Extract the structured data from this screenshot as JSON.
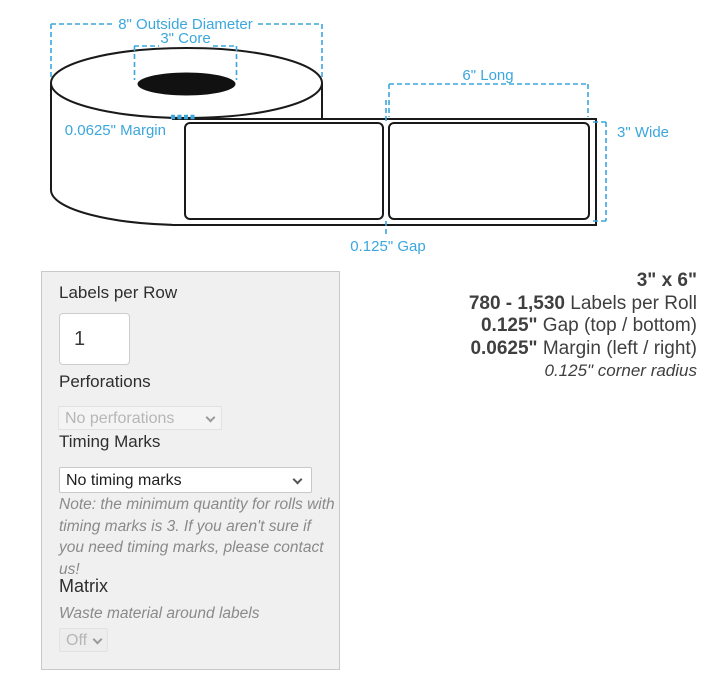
{
  "colors": {
    "annotation": "#3ba7dc",
    "panel_bg": "#f0f0f0",
    "line": "#1a1a1a"
  },
  "diagram": {
    "outside_diameter_label": "8\" Outside Diameter",
    "core_label": "3\" Core",
    "margin_label": "0.0625\" Margin",
    "long_label": "6\" Long",
    "wide_label": "3\" Wide",
    "gap_label": "0.125\" Gap"
  },
  "options_panel": {
    "labels_per_row": {
      "label": "Labels per Row",
      "value": "1"
    },
    "perforations": {
      "label": "Perforations",
      "selected": "No perforations"
    },
    "timing_marks": {
      "label": "Timing Marks",
      "selected": "No timing marks",
      "note": "Note: the minimum quantity for rolls with timing marks is 3. If you aren't sure if you need timing marks, please contact us!"
    },
    "matrix": {
      "label": "Matrix",
      "description": "Waste material around labels",
      "selected": "Off"
    }
  },
  "spec_summary": {
    "size": "3\" x 6\"",
    "labels_per_roll_value": "780 - 1,530",
    "labels_per_roll_text": " Labels per Roll",
    "gap_value": "0.125\"",
    "gap_text": " Gap (top / bottom)",
    "margin_value": "0.0625\"",
    "margin_text": " Margin (left / right)",
    "corner_radius": "0.125\" corner radius"
  }
}
